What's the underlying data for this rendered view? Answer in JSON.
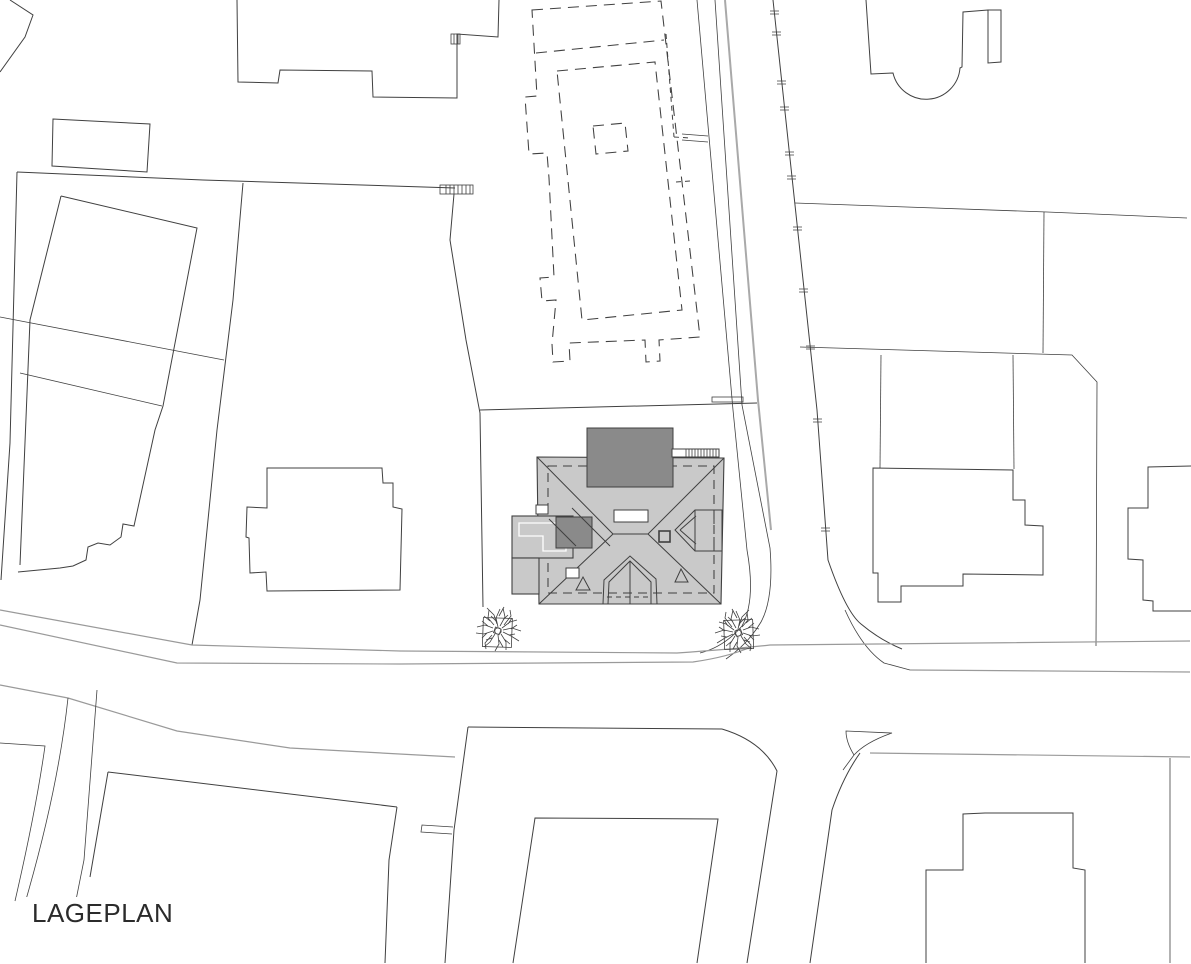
{
  "title": {
    "label": "LAGEPLAN"
  },
  "colors": {
    "background": "#ffffff",
    "line_dark": "#404040",
    "line_gray": "#9a9a9a",
    "roof_fill": "#c9c9c9",
    "roof_dark_fill": "#8a8a8a",
    "white_fill": "#ffffff",
    "text": "#2b2b2b"
  }
}
